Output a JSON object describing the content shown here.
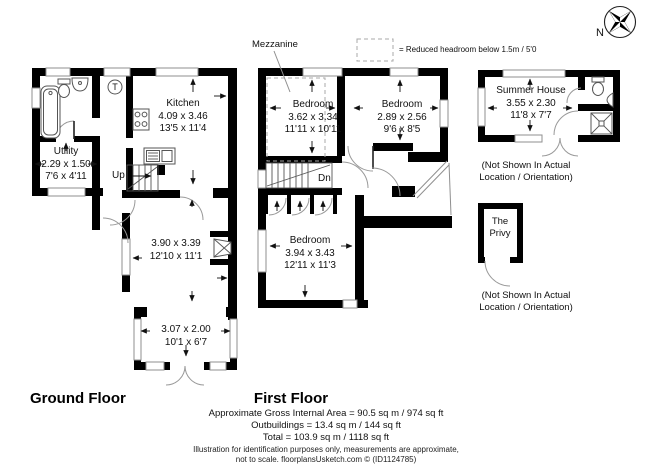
{
  "ground_floor": {
    "title": "Ground Floor",
    "stairs_label": "Up",
    "thermostat_label": "T",
    "rooms": {
      "utility": {
        "name": "Utility",
        "metric": "2.29 x 1.50",
        "imperial": "7'6 x 4'11"
      },
      "kitchen": {
        "name": "Kitchen",
        "metric": "4.09 x 3.46",
        "imperial": "13'5 x 11'4"
      },
      "sitting_room": {
        "metric": "3.90 x 3.39",
        "imperial": "12'10 x 11'1"
      },
      "garden_room": {
        "metric": "3.07 x 2.00",
        "imperial": "10'1 x 6'7"
      }
    }
  },
  "first_floor": {
    "title": "First Floor",
    "stairs_label": "Dn",
    "mezzanine_label": "Mezzanine",
    "legend_text": "= Reduced headroom below 1.5m / 5'0",
    "rooms": {
      "bedroom1": {
        "name": "Bedroom",
        "metric": "3.62 x 3.34",
        "imperial": "11'11 x 10'11"
      },
      "bedroom2": {
        "name": "Bedroom",
        "metric": "2.89 x 2.56",
        "imperial": "9'6 x 8'5"
      },
      "bedroom3": {
        "name": "Bedroom",
        "metric": "3.94 x 3.43",
        "imperial": "12'11 x 11'3"
      }
    }
  },
  "outbuildings": {
    "summer_house": {
      "name": "Summer House",
      "metric": "3.55 x 2.30",
      "imperial": "11'8 x 7'7",
      "note_line1": "(Not Shown In Actual",
      "note_line2": "Location / Orientation)"
    },
    "privy": {
      "name_line1": "The",
      "name_line2": "Privy",
      "note_line1": "(Not Shown In Actual",
      "note_line2": "Location / Orientation)"
    }
  },
  "compass": {
    "label": "N"
  },
  "footer": {
    "area_line": "Approximate Gross Internal Area = 90.5 sq m / 974 sq ft",
    "outbuildings_line": "Outbuildings = 13.4 sq m / 144 sq ft",
    "total_line": "Total = 103.9 sq m / 1118 sq ft",
    "disclaimer_line1": "Illustration for identification purposes only, measurements are approximate,",
    "disclaimer_line2": "not to scale. floorplansUsketch.com © (ID1124785)"
  },
  "colors": {
    "wall": "#000000",
    "window_line": "#8f8f8f",
    "door_arc": "#999999",
    "text": "#111111"
  }
}
